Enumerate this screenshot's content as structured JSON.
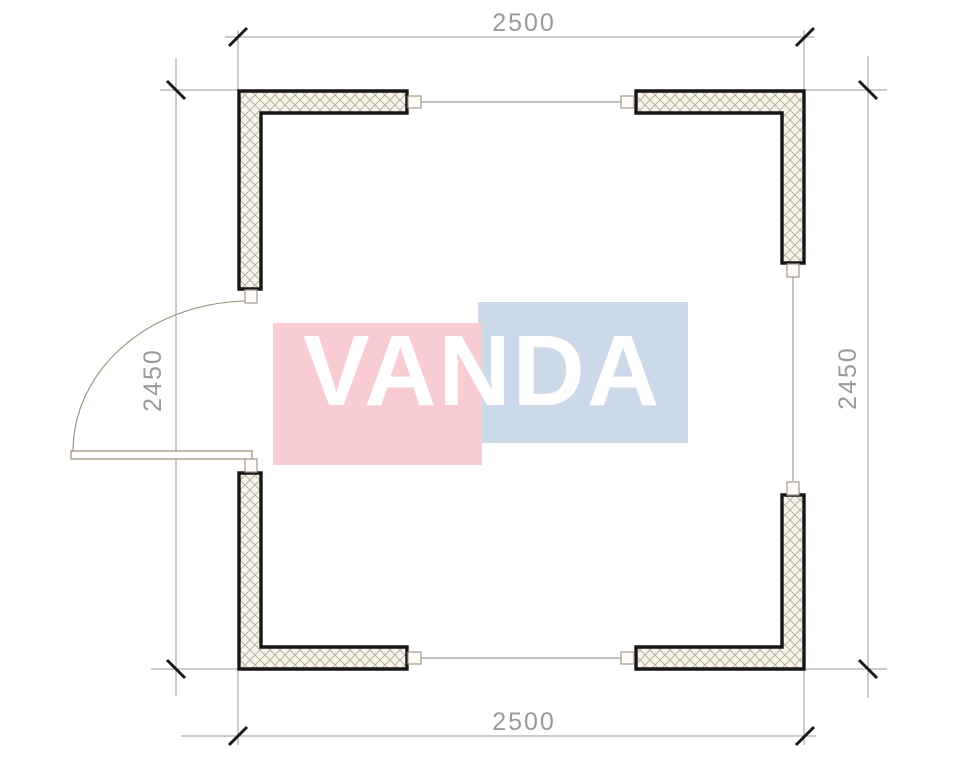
{
  "watermark": {
    "text": "VANDA",
    "pink_color": "#f9cbd3",
    "blue_color": "#ccd9e8",
    "text_color": "#ffffff"
  },
  "dimensions": {
    "top": "2500",
    "bottom": "2500",
    "left": "2450",
    "right": "2450"
  },
  "colors": {
    "background": "#ffffff",
    "wall_outline": "#161616",
    "wall_fill": "#f6f3ec",
    "hatch_line": "#b5a88c",
    "dimension_line": "#9a9a9a",
    "dimension_text": "#9a9a9a",
    "tick": "#1a1a1a",
    "joint_line": "#ababab",
    "connector_outline": "#a39a87",
    "door_line": "#9b8d72"
  }
}
